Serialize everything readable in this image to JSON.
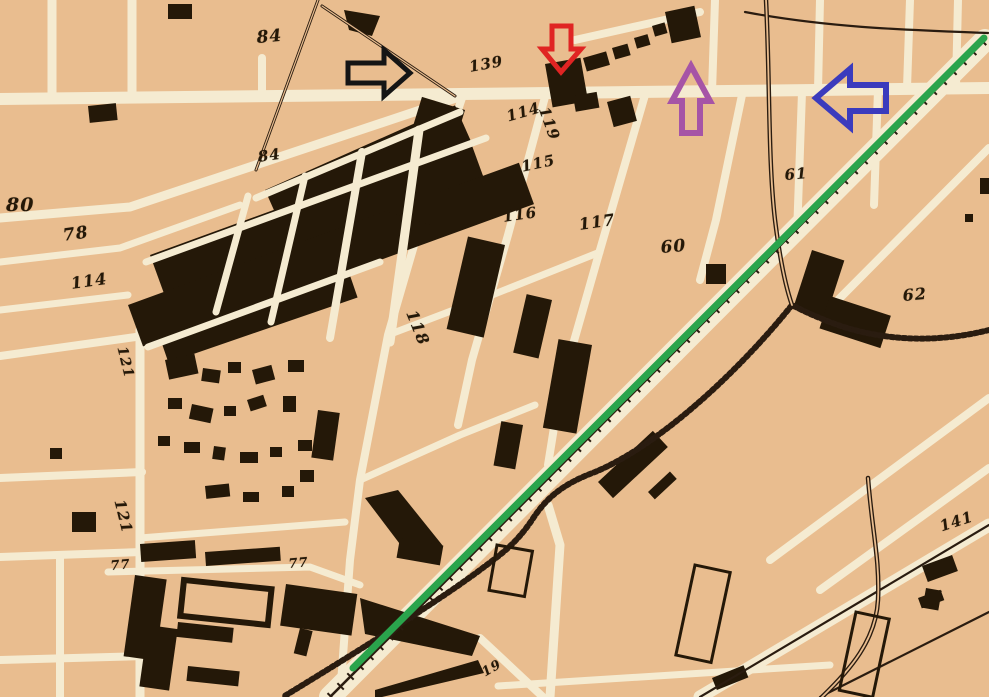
{
  "map": {
    "title": "historic city plan with block numbers",
    "background_color": "#e9bd8f",
    "street_color": "#f5ebd1",
    "building_color": "#241808",
    "labels": [
      {
        "text": "84",
        "x": 256,
        "y": 30,
        "rot": -5,
        "size": 17
      },
      {
        "text": "84",
        "x": 257,
        "y": 150,
        "rot": -8,
        "size": 15
      },
      {
        "text": "139",
        "x": 468,
        "y": 60,
        "rot": -10,
        "size": 15
      },
      {
        "text": "80",
        "x": 6,
        "y": 196,
        "rot": 0,
        "size": 19
      },
      {
        "text": "78",
        "x": 62,
        "y": 228,
        "rot": -8,
        "size": 17
      },
      {
        "text": "114",
        "x": 70,
        "y": 276,
        "rot": -8,
        "size": 16
      },
      {
        "text": "114",
        "x": 505,
        "y": 110,
        "rot": -16,
        "size": 15
      },
      {
        "text": "119",
        "x": 550,
        "y": 105,
        "rot": 70,
        "size": 15
      },
      {
        "text": "115",
        "x": 520,
        "y": 160,
        "rot": -12,
        "size": 15
      },
      {
        "text": "116",
        "x": 502,
        "y": 210,
        "rot": -8,
        "size": 15
      },
      {
        "text": "117",
        "x": 578,
        "y": 217,
        "rot": -8,
        "size": 16
      },
      {
        "text": "118",
        "x": 418,
        "y": 308,
        "rot": 68,
        "size": 16
      },
      {
        "text": "60",
        "x": 660,
        "y": 240,
        "rot": -5,
        "size": 17
      },
      {
        "text": "61",
        "x": 784,
        "y": 168,
        "rot": -5,
        "size": 15
      },
      {
        "text": "62",
        "x": 902,
        "y": 288,
        "rot": -5,
        "size": 16
      },
      {
        "text": "121",
        "x": 128,
        "y": 345,
        "rot": 76,
        "size": 14
      },
      {
        "text": "121",
        "x": 126,
        "y": 498,
        "rot": 76,
        "size": 15
      },
      {
        "text": "77",
        "x": 110,
        "y": 560,
        "rot": -5,
        "size": 13
      },
      {
        "text": "77",
        "x": 288,
        "y": 558,
        "rot": -5,
        "size": 13
      },
      {
        "text": "141",
        "x": 938,
        "y": 520,
        "rot": -18,
        "size": 15
      },
      {
        "text": "19",
        "x": 480,
        "y": 668,
        "rot": -30,
        "size": 13
      }
    ]
  },
  "annotations": {
    "green_line": {
      "color": "#2aa44c",
      "x1": 353,
      "y1": 668,
      "x2": 984,
      "y2": 38,
      "width": 7
    },
    "arrows": [
      {
        "id": "black-arrow-right",
        "direction": "right",
        "color": "#151515"
      },
      {
        "id": "red-arrow-down",
        "direction": "down",
        "color": "#e02423"
      },
      {
        "id": "purple-arrow-up",
        "direction": "up",
        "color": "#a654a6"
      },
      {
        "id": "blue-arrow-left",
        "direction": "left",
        "color": "#3b3bbd"
      }
    ]
  }
}
